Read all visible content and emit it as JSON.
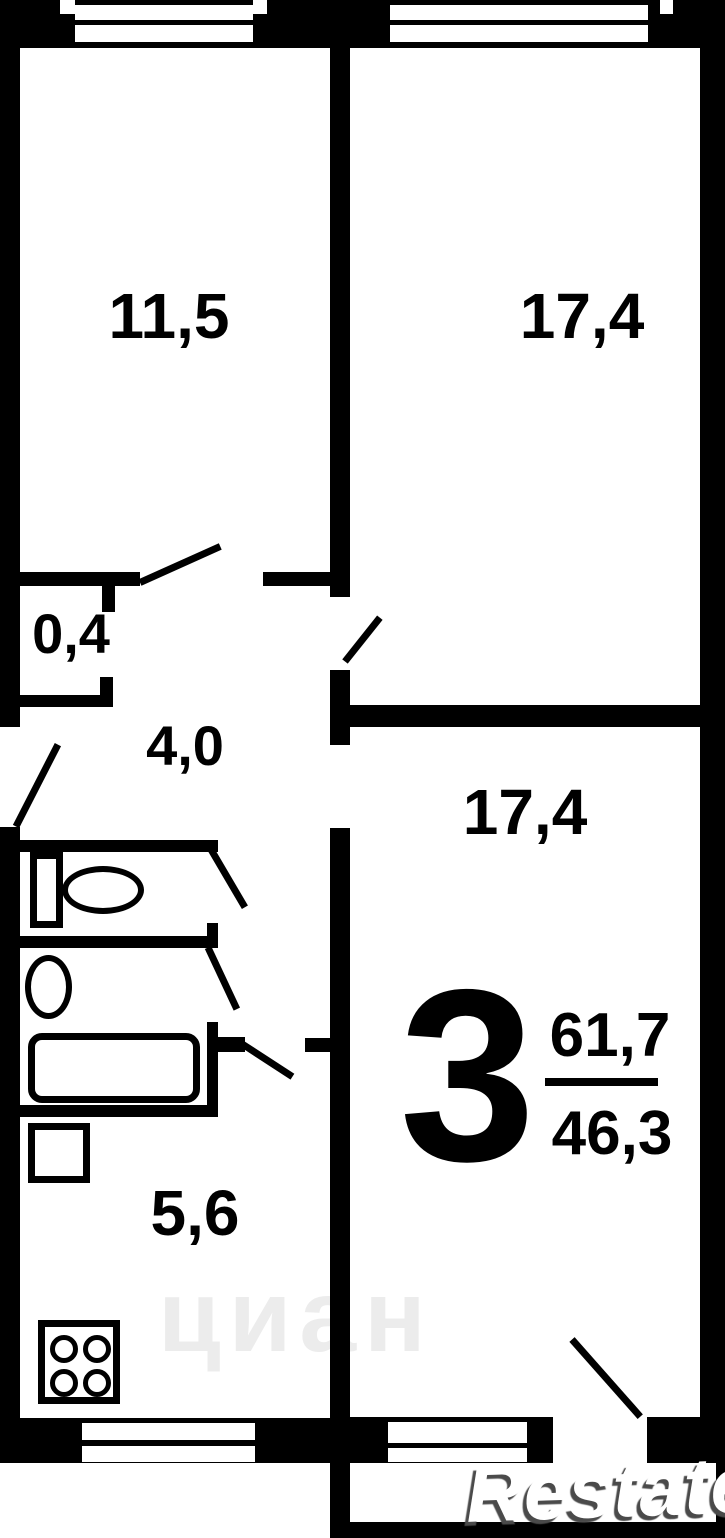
{
  "floor_plan": {
    "type": "apartment-floor-plan",
    "rooms": [
      {
        "id": "room-top-left",
        "area_label": "11,5"
      },
      {
        "id": "room-top-right",
        "area_label": "17,4"
      },
      {
        "id": "closet",
        "area_label": "0,4"
      },
      {
        "id": "hallway",
        "area_label": "4,0"
      },
      {
        "id": "room-bottom-right",
        "area_label": "17,4"
      },
      {
        "id": "kitchen",
        "area_label": "5,6"
      }
    ],
    "summary": {
      "rooms_count": "3",
      "total_area": "61,7",
      "living_area": "46,3"
    },
    "fixtures": [
      "toilet",
      "sink",
      "bathtub",
      "washing-machine",
      "stove"
    ],
    "watermarks": {
      "center": "циан",
      "bottom_right": "Restate"
    },
    "colors": {
      "wall": "#000000",
      "background": "#ffffff",
      "watermark_faint": "#ececec"
    }
  }
}
